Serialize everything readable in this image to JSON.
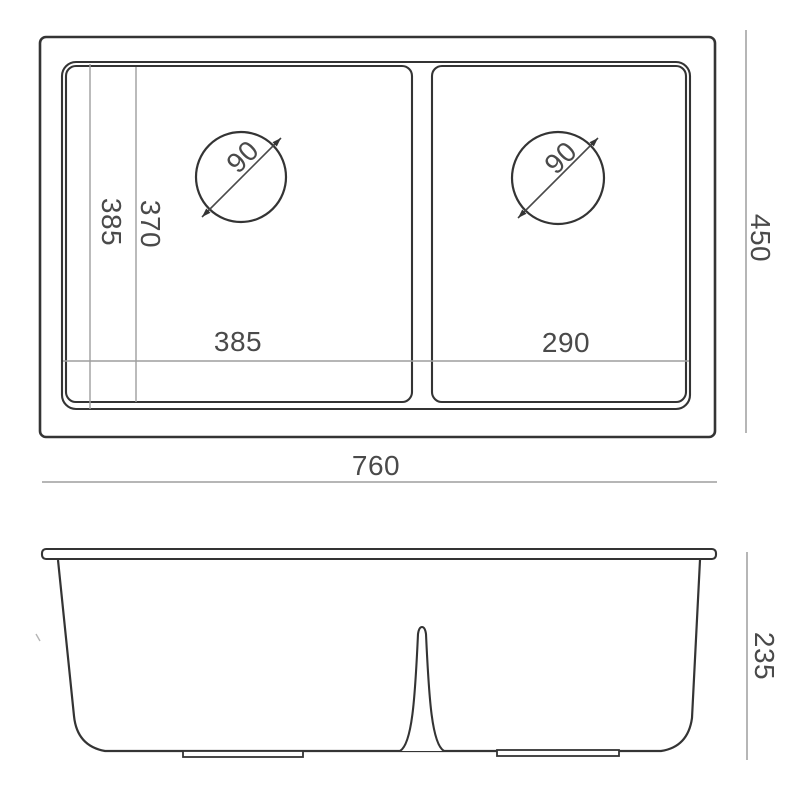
{
  "drawing": {
    "type": "sink-dimension-drawing",
    "views": [
      "top-plan-view",
      "front-elevation-view"
    ]
  },
  "view_top": {
    "overall_width": "760",
    "overall_depth": "450",
    "inner_length": "385",
    "bowl_inner_length": "370",
    "left_bowl_width": "385",
    "right_bowl_width": "290",
    "left_drain_diameter": "90",
    "right_drain_diameter": "90"
  },
  "view_front": {
    "overall_height": "235"
  },
  "colors": {
    "line": "#343434",
    "dim_line": "#9e9e9e",
    "text": "#4a4a4a",
    "background": "#ffffff"
  }
}
